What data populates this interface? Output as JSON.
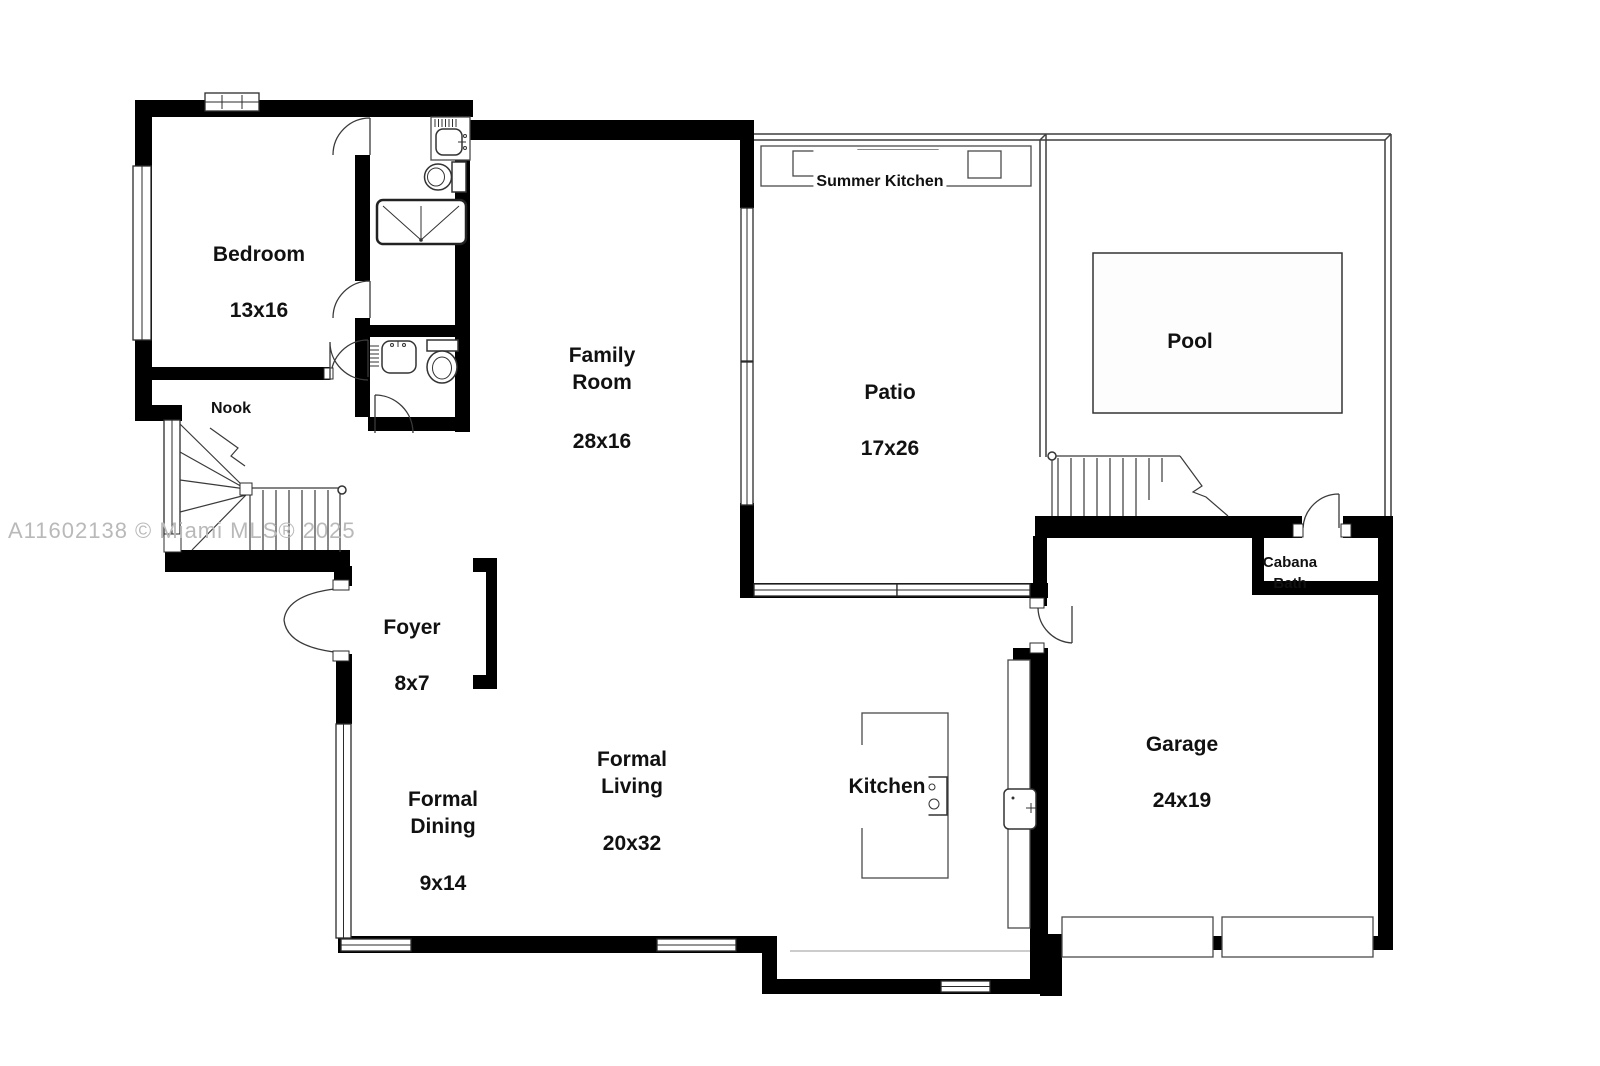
{
  "watermark": {
    "text": "A11602138 © Miami MLS® 2025"
  },
  "rooms": {
    "bedroom": {
      "name": "Bedroom",
      "dims": "13x16"
    },
    "nook": {
      "name": "Nook"
    },
    "family_room": {
      "name": "Family\nRoom",
      "dims": "28x16"
    },
    "patio": {
      "name": "Patio",
      "dims": "17x26"
    },
    "pool": {
      "name": "Pool"
    },
    "summer_kitchen": {
      "name": "Summer Kitchen"
    },
    "cabana_bath": {
      "name": "Cabana\nBath"
    },
    "foyer": {
      "name": "Foyer",
      "dims": "8x7"
    },
    "formal_dining": {
      "name": "Formal\nDining",
      "dims": "9x14"
    },
    "formal_living": {
      "name": "Formal\nLiving",
      "dims": "20x32"
    },
    "kitchen": {
      "name": "Kitchen"
    },
    "garage": {
      "name": "Garage",
      "dims": "24x19"
    }
  },
  "colors": {
    "wall": "#000000",
    "line": "#3f3f3f",
    "watermark": "#b9b9b9",
    "background": "#ffffff"
  }
}
